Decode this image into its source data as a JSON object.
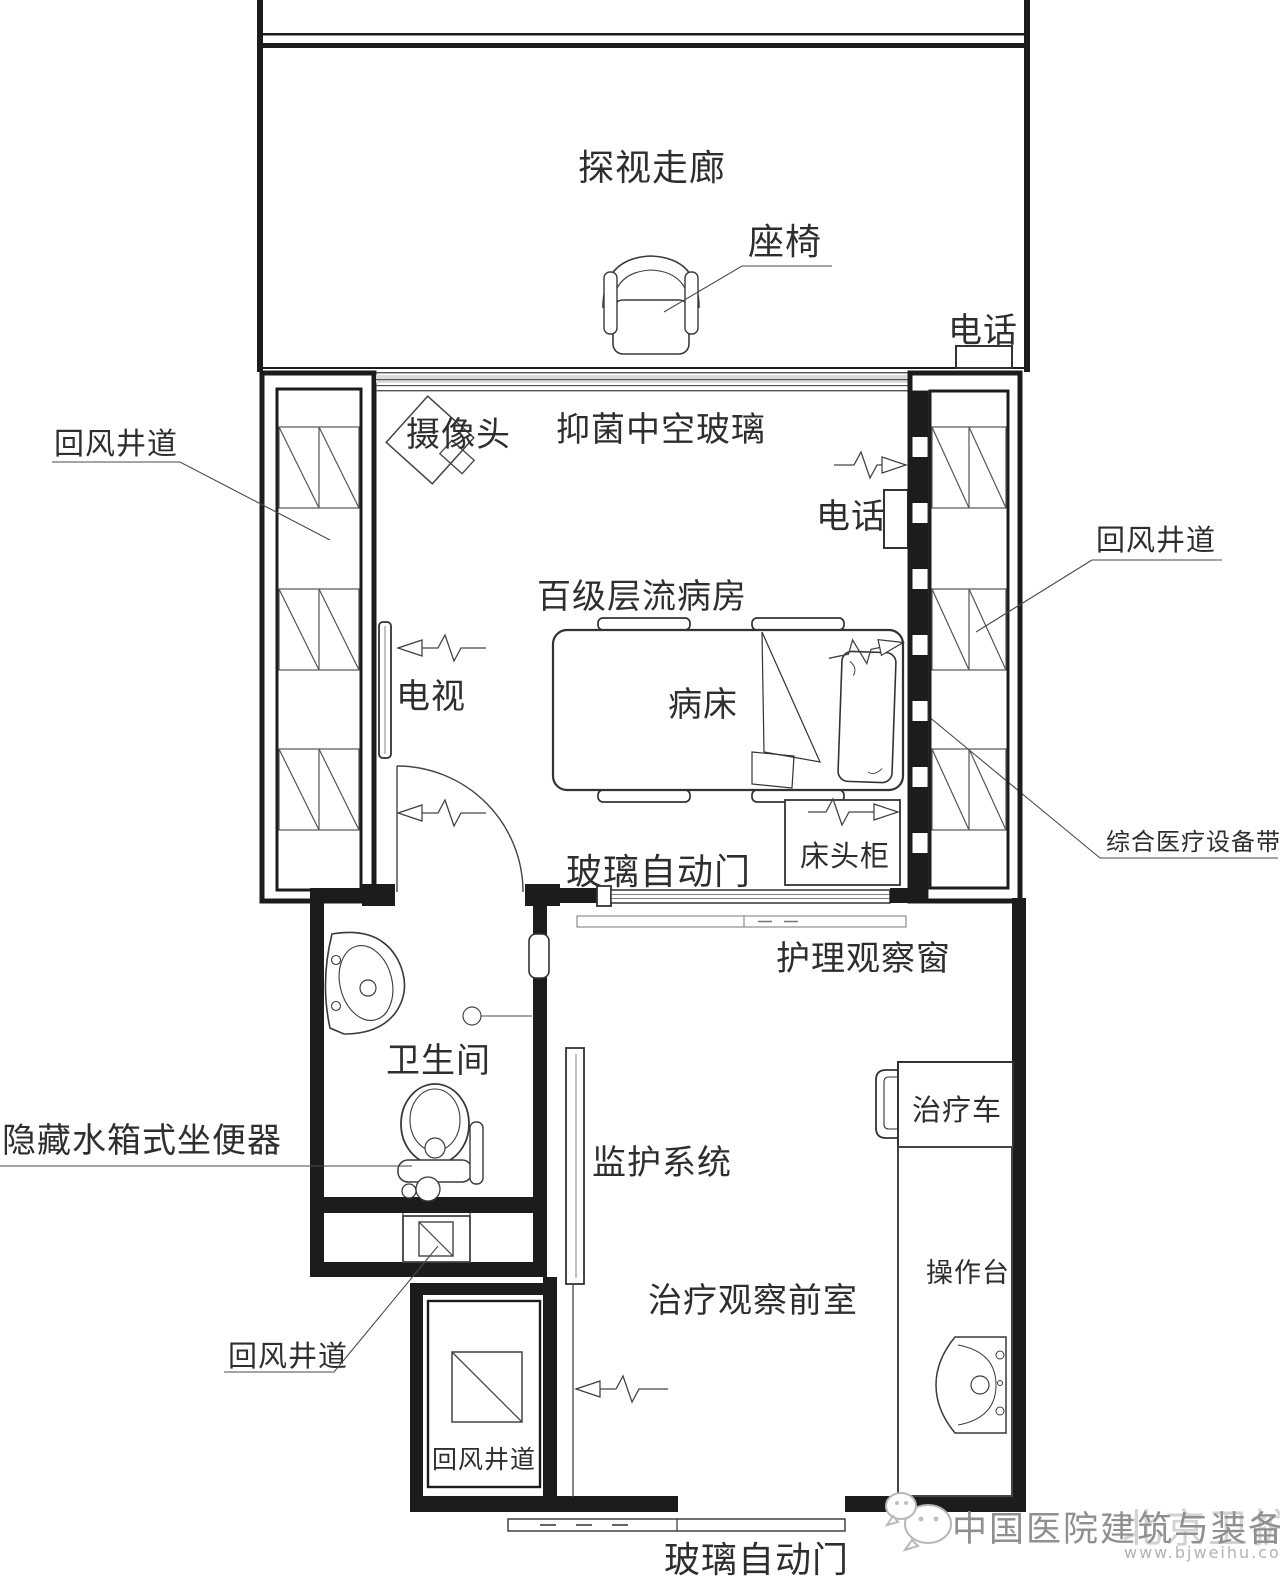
{
  "colors": {
    "line": "#1c1c1c",
    "furniture_line": "#333333",
    "leader_line": "#4a4a4a",
    "text": "#2e2e2e",
    "glass_band": "#dcdcdc",
    "watermark_text": "#8f8f8f",
    "watermark_overlay": "#cbcbcb",
    "watermark_url": "#b2b2b2"
  },
  "corridor": {
    "label": "探视走廊",
    "seat": "座椅",
    "phone": "电话"
  },
  "ward": {
    "label": "百级层流病房",
    "camera": "摄像头",
    "glass": "抑菌中空玻璃",
    "phone": "电话",
    "tv": "电视",
    "bed": "病床",
    "bedside_cabinet": "床头柜",
    "auto_door": "玻璃自动门",
    "observation_window": "护理观察窗"
  },
  "shafts": {
    "left": "回风井道",
    "right": "回风井道",
    "duct": "回风井道",
    "lower": "回风井道"
  },
  "equipment_band_label": "综合医疗设备带",
  "bathroom": {
    "label": "卫生间",
    "toilet": "隐藏水箱式坐便器"
  },
  "anteroom": {
    "label": "治疗观察前室",
    "monitor": "监护系统",
    "cart": "治疗车",
    "worktop": "操作台",
    "auto_door": "玻璃自动门"
  },
  "watermark": {
    "brand": "中国医院建筑与装备",
    "site": "www.bjweihu.com",
    "overlay": "北京卫护"
  }
}
